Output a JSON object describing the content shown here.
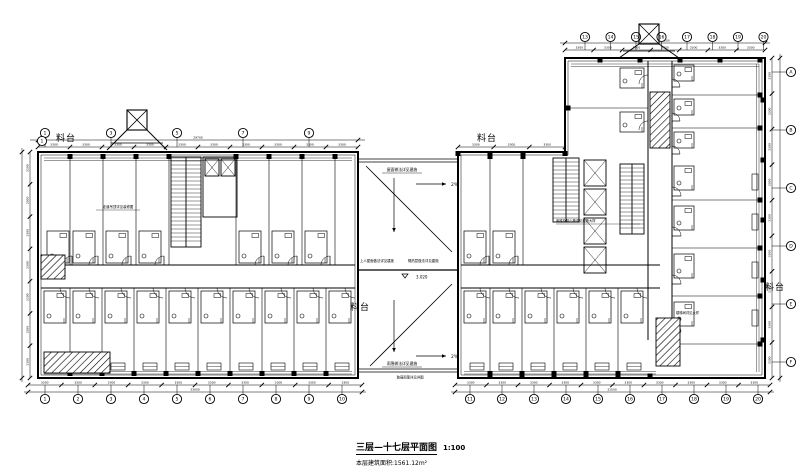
{
  "page": {
    "background": "#ffffff",
    "ink": "#111111"
  },
  "title": {
    "name": "三层—十七层平面图",
    "scale": "1:100",
    "area_note": "本层建筑面积:1561.12m²"
  },
  "labels": {
    "platform": "料台"
  },
  "annotations": {
    "slope": "2%",
    "elevation": "3.020",
    "roof_note": "屋面做法详见建施",
    "roof_left": "上人屋面做法详见建施",
    "roof_right": "隔热层做法详见建施",
    "canopy_note": "雨篷做法详见建施",
    "canopy_sub": "玻璃雨篷详见详图",
    "corridor_note": "走道吊顶详见装修图",
    "core_note": "电梯及核心筒详见建施大样",
    "stair_note": "楼梯间详见大样"
  },
  "dims": {
    "bay": "3300",
    "end": "1500"
  },
  "axes": {
    "bottom_left": [
      "1",
      "2",
      "3",
      "4",
      "5",
      "6",
      "7",
      "8",
      "9",
      "10"
    ],
    "bottom_right": [
      "11",
      "12",
      "13",
      "14",
      "15",
      "16",
      "17",
      "18",
      "19",
      "20"
    ],
    "top_left": [
      "1",
      "3",
      "5",
      "7",
      "9"
    ],
    "top_wing": [
      "13",
      "14",
      "15",
      "16",
      "17",
      "18",
      "19",
      "20"
    ],
    "right_side": [
      "A",
      "B",
      "C",
      "D",
      "E",
      "F"
    ]
  }
}
